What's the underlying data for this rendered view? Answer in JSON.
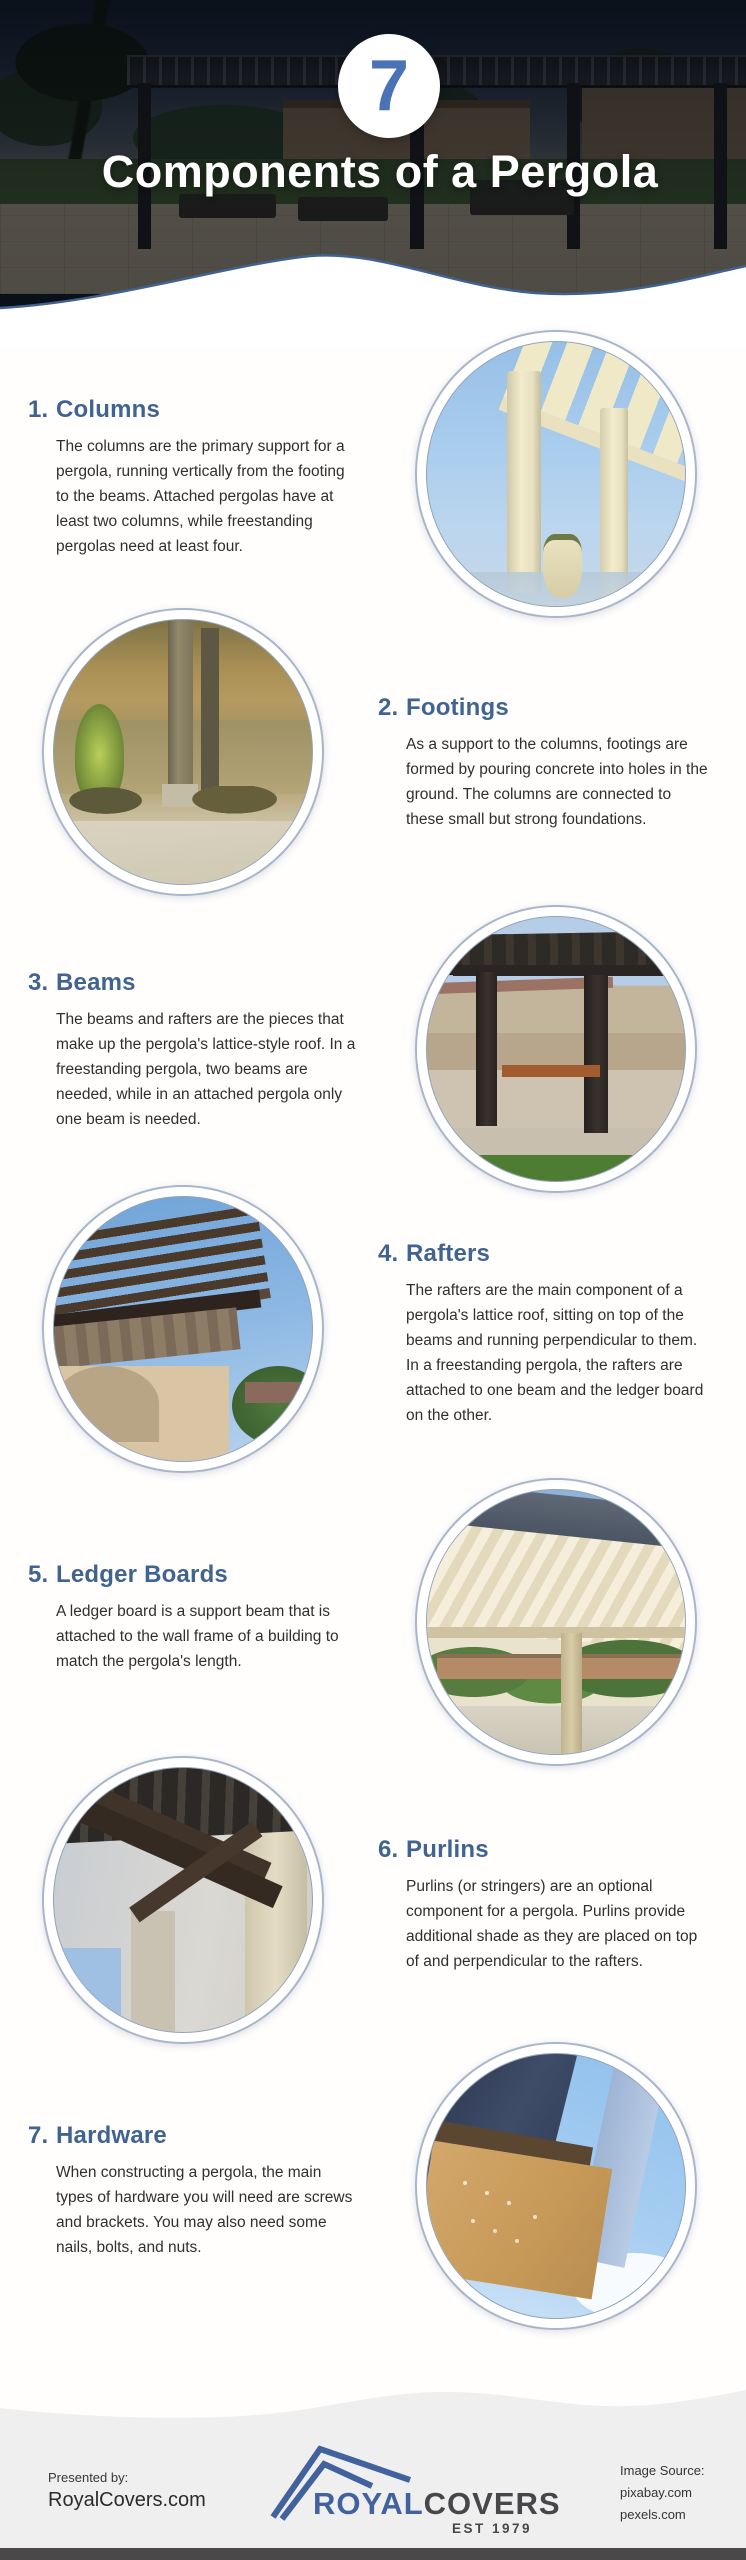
{
  "header": {
    "badge_number": "7",
    "title": "Components of a Pergola"
  },
  "sections": [
    {
      "number": "1.",
      "title": "Columns",
      "body": "The columns are the primary support for a pergola, running vertically from the footing to the beams. Attached pergolas have at least two columns, while freestanding pergolas need at least four.",
      "image_side": "right",
      "image_name": "white-classical-columns-photo"
    },
    {
      "number": "2.",
      "title": "Footings",
      "body": "As a support to the columns, footings are formed by pouring concrete into holes in the ground. The columns are connected to these small but strong foundations.",
      "image_side": "left",
      "image_name": "lakeside-wooden-posts-photo"
    },
    {
      "number": "3.",
      "title": "Beams",
      "body": "The beams and rafters are the pieces that make up the pergola's lattice-style roof. In a freestanding pergola, two beams are needed, while in an attached pergola only one beam is needed.",
      "image_side": "right",
      "image_name": "dark-pergola-picnic-table-photo"
    },
    {
      "number": "4.",
      "title": "Rafters",
      "body": "The rafters are the main component of a pergola's lattice roof, sitting on top of the beams and running perpendicular to them. In a freestanding pergola, the rafters are attached to one beam and the ledger board on the other.",
      "image_side": "left",
      "image_name": "pergola-lattice-roof-photo"
    },
    {
      "number": "5.",
      "title": "Ledger Boards",
      "body": "A ledger board is a support beam that is attached to the wall frame of a building to match the pergola's length.",
      "image_side": "right",
      "image_name": "patio-cover-underside-photo"
    },
    {
      "number": "6.",
      "title": "Purlins",
      "body": "Purlins (or stringers) are an optional component for a pergola. Purlins provide additional shade as they are placed on top of and perpendicular to the rafters.",
      "image_side": "left",
      "image_name": "pergola-braces-detail-photo"
    },
    {
      "number": "7.",
      "title": "Hardware",
      "body": "When constructing a pergola, the main types of hardware you will need are screws and brackets. You may also need some nails, bolts, and nuts.",
      "image_side": "right",
      "image_name": "pergola-corner-hardware-photo"
    }
  ],
  "footer": {
    "presented_by_label": "Presented by:",
    "presented_by_site": "RoyalCovers.com",
    "logo_royal": "ROYAL",
    "logo_covers": "COVERS",
    "logo_est": "EST 1979",
    "image_source_label": "Image Source:",
    "image_source_1": "pixabay.com",
    "image_source_2": "pexels.com"
  },
  "colors": {
    "heading_blue": "#40648f",
    "badge_blue": "#4a73b5",
    "wave_stroke": "#41618f",
    "body_text": "#2f2f31",
    "footer_background": "#efefef",
    "logo_blue": "#41629c",
    "logo_dark": "#47474b",
    "bottom_bar": "#4a4848"
  }
}
